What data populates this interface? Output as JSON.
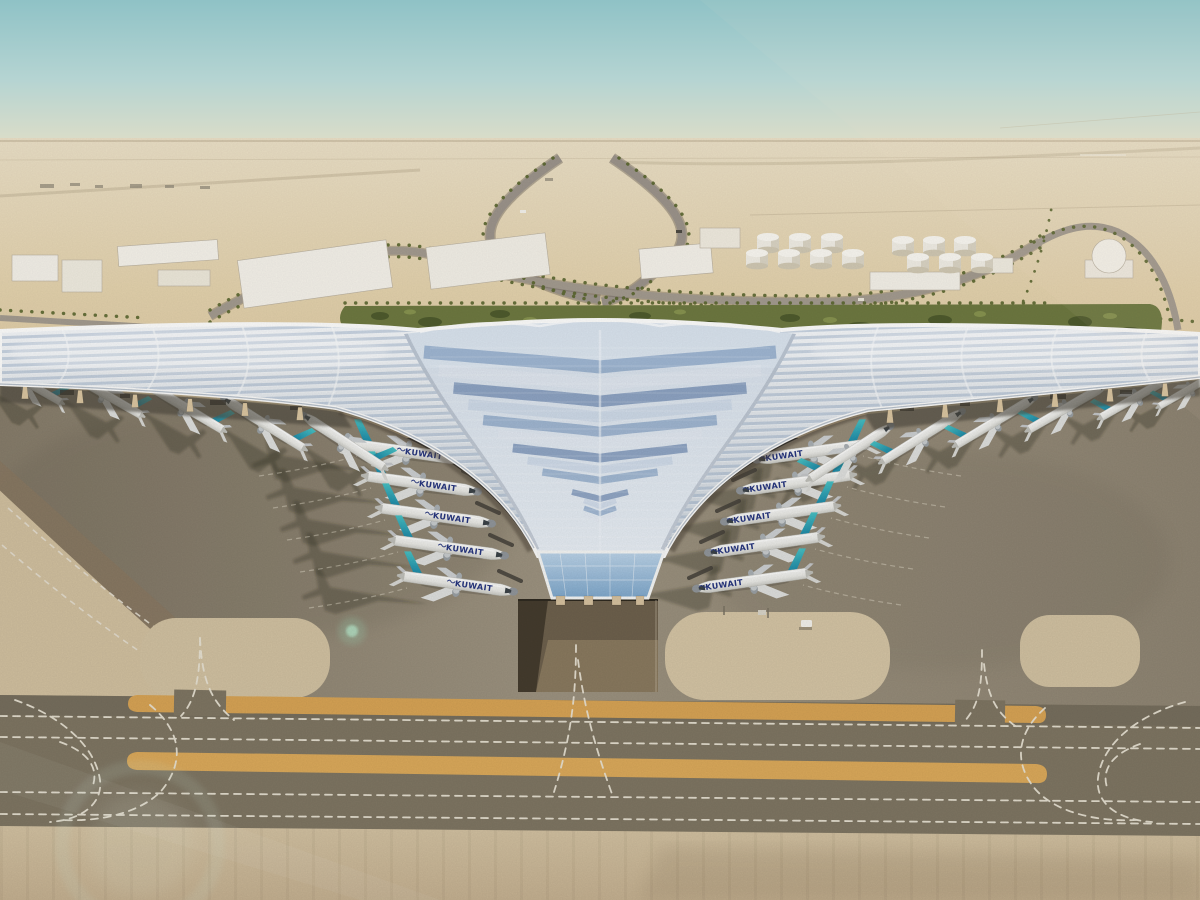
{
  "meta": {
    "type": "architectural-aerial-rendering",
    "subject": "Aerial rendering of a trefoil-roofed desert airport terminal with Kuwait-liveried aircraft",
    "width": 1200,
    "height": 900
  },
  "airline": {
    "title": "KUWAIT",
    "has_arabic_script": true,
    "title_color": "#27367f",
    "tail_color_top": "#49c2c4",
    "tail_color_bottom": "#1b86a6"
  },
  "scene": {
    "palette": {
      "sky_top": "#8fc2c6",
      "sky_mid": "#c9dbd2",
      "sky_horizon": "#e9e0ca",
      "sand_far": "#eadfc6",
      "sand_mid": "#e2d1ac",
      "sand_near": "#d8c39c",
      "garden_green": "#6d7840",
      "garden_dark": "#49552a",
      "road_gray": "#9b938a",
      "apron_gray": "#948a77",
      "taxiway_dark": "#7f7663",
      "strip_orange": "#d8a455",
      "concrete_light": "#d0bf9f",
      "roof_silver": "#eef1f4",
      "roof_blue": "#7d9cc3",
      "roof_edge_white": "#fbfbfa",
      "canopy_shadow": "#4a443a",
      "column_tan": "#dcc7a2",
      "title_navy": "#27367f",
      "marking_white": "#e9e3d4"
    },
    "counts": {
      "center_left_aircraft": 5,
      "center_right_aircraft": 5,
      "left_wing_aircraft": 5,
      "right_wing_aircraft": 6,
      "fuel_tanks": 13
    },
    "aircraft": [
      {
        "group": "center-left",
        "x": 409,
        "y": 452,
        "rot": 8,
        "s": 0.95,
        "m": false,
        "lbl": true
      },
      {
        "group": "center-left",
        "x": 423,
        "y": 484,
        "rot": 8,
        "s": 0.95,
        "m": false,
        "lbl": true
      },
      {
        "group": "center-left",
        "x": 437,
        "y": 516,
        "rot": 8,
        "s": 0.95,
        "m": false,
        "lbl": true
      },
      {
        "group": "center-left",
        "x": 450,
        "y": 548,
        "rot": 8,
        "s": 0.95,
        "m": false,
        "lbl": true
      },
      {
        "group": "center-left",
        "x": 459,
        "y": 584,
        "rot": 8,
        "s": 0.95,
        "m": false,
        "lbl": true
      },
      {
        "group": "center-right",
        "x": 811,
        "y": 452,
        "rot": -8,
        "s": 0.95,
        "m": true,
        "lbl": true
      },
      {
        "group": "center-right",
        "x": 795,
        "y": 483,
        "rot": -8,
        "s": 0.95,
        "m": true,
        "lbl": true
      },
      {
        "group": "center-right",
        "x": 779,
        "y": 514,
        "rot": -8,
        "s": 0.95,
        "m": true,
        "lbl": true
      },
      {
        "group": "center-right",
        "x": 763,
        "y": 545,
        "rot": -8,
        "s": 0.95,
        "m": true,
        "lbl": true
      },
      {
        "group": "center-right",
        "x": 751,
        "y": 581,
        "rot": -8,
        "s": 0.95,
        "m": true,
        "lbl": true
      },
      {
        "group": "wing-left",
        "x": 26,
        "y": 382,
        "rot": 30,
        "s": 0.68,
        "m": true,
        "lbl": false
      },
      {
        "group": "wing-left",
        "x": 103,
        "y": 393,
        "rot": 30,
        "s": 0.74,
        "m": true,
        "lbl": false
      },
      {
        "group": "wing-left",
        "x": 183,
        "y": 406,
        "rot": 31,
        "s": 0.78,
        "m": true,
        "lbl": false
      },
      {
        "group": "wing-left",
        "x": 263,
        "y": 423,
        "rot": 32,
        "s": 0.8,
        "m": true,
        "lbl": false
      },
      {
        "group": "wing-left",
        "x": 343,
        "y": 441,
        "rot": 33,
        "s": 0.82,
        "m": true,
        "lbl": false
      },
      {
        "group": "wing-right",
        "x": 851,
        "y": 452,
        "rot": -33,
        "s": 0.82,
        "m": false,
        "lbl": false
      },
      {
        "group": "wing-right",
        "x": 923,
        "y": 436,
        "rot": -32,
        "s": 0.8,
        "m": false,
        "lbl": false
      },
      {
        "group": "wing-right",
        "x": 996,
        "y": 421,
        "rot": -31,
        "s": 0.78,
        "m": false,
        "lbl": false
      },
      {
        "group": "wing-right",
        "x": 1068,
        "y": 407,
        "rot": -30,
        "s": 0.76,
        "m": false,
        "lbl": false
      },
      {
        "group": "wing-right",
        "x": 1138,
        "y": 396,
        "rot": -30,
        "s": 0.72,
        "m": false,
        "lbl": false
      },
      {
        "group": "wing-right",
        "x": 1191,
        "y": 388,
        "rot": -30,
        "s": 0.62,
        "m": false,
        "lbl": false
      }
    ],
    "fuel_tanks": [
      {
        "cx": 768,
        "cy": 240
      },
      {
        "cx": 800,
        "cy": 240
      },
      {
        "cx": 832,
        "cy": 240
      },
      {
        "cx": 757,
        "cy": 256
      },
      {
        "cx": 789,
        "cy": 256
      },
      {
        "cx": 821,
        "cy": 256
      },
      {
        "cx": 853,
        "cy": 256
      },
      {
        "cx": 903,
        "cy": 243
      },
      {
        "cx": 934,
        "cy": 243
      },
      {
        "cx": 965,
        "cy": 243
      },
      {
        "cx": 918,
        "cy": 260
      },
      {
        "cx": 950,
        "cy": 260
      },
      {
        "cx": 982,
        "cy": 260
      }
    ]
  }
}
